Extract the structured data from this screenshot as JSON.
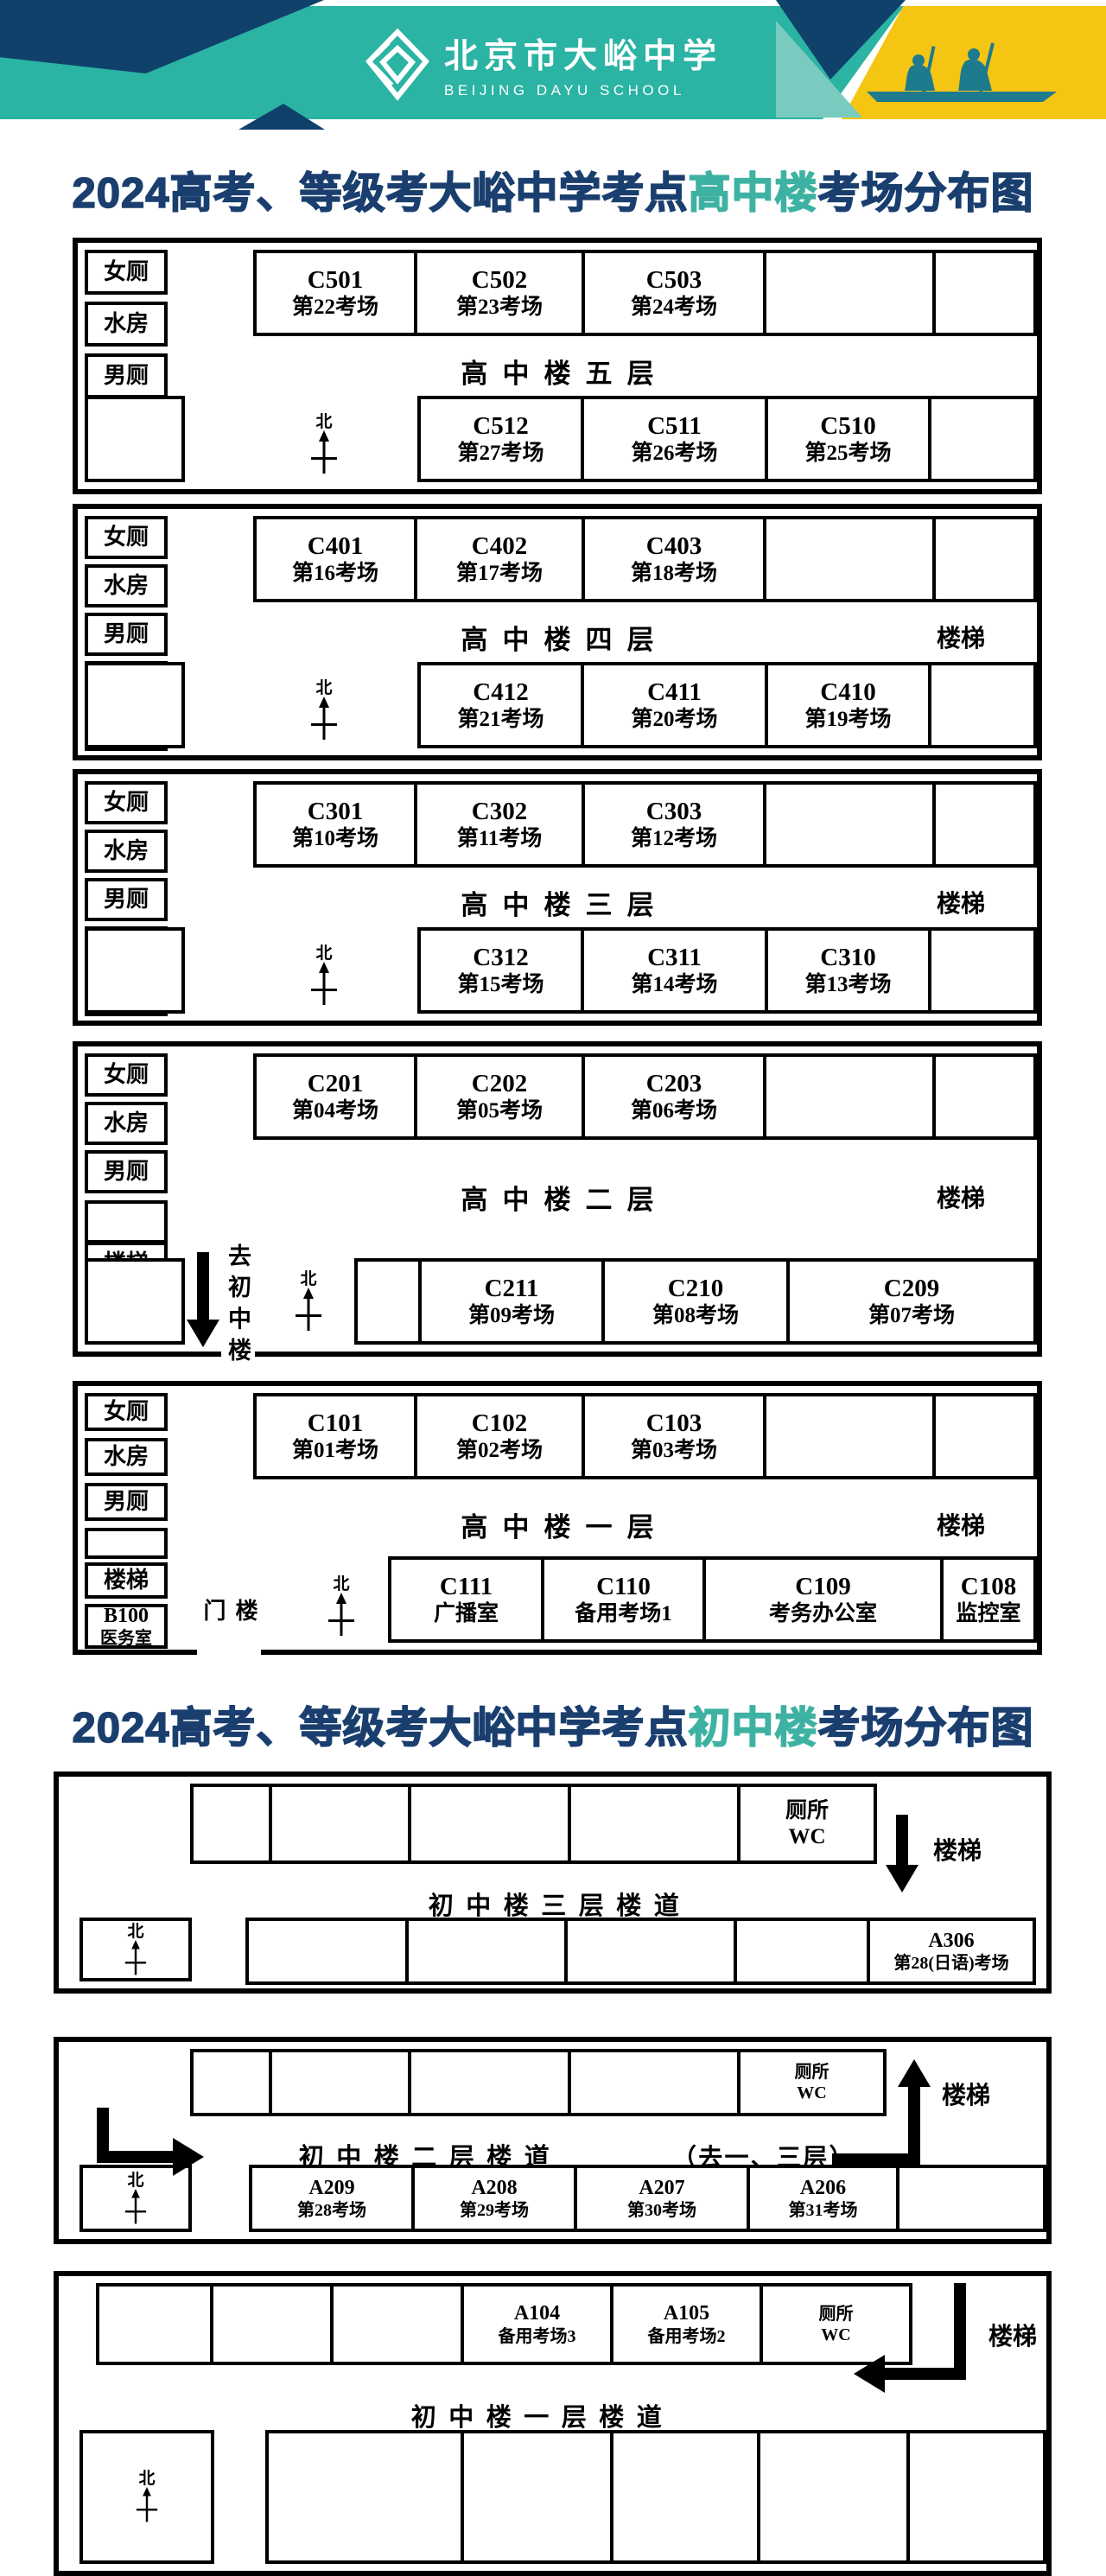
{
  "header": {
    "school_name_cn": "北京市大峪中学",
    "school_name_en": "BEIJING DAYU SCHOOL"
  },
  "colors": {
    "teal": "#2bb3a3",
    "navy": "#0f416b",
    "title-navy": "#1a3f6f",
    "title-teal": "#3eb2a2",
    "yellow": "#f5c513",
    "rower": "#1e7b8e",
    "light-teal": "#79cbc0"
  },
  "titles": {
    "hs": {
      "prefix": "2024高考、等级考大峪中学考点",
      "highlight": "高中楼",
      "suffix": "考场分布图"
    },
    "js": {
      "prefix": "2024高考、等级考大峪中学考点",
      "highlight": "初中楼",
      "suffix": "考场分布图"
    }
  },
  "common": {
    "north": "北",
    "stairs": "楼梯",
    "toilet_cn": "厕所",
    "toilet_en": "WC",
    "women": "女厕",
    "water": "水房",
    "men": "男厕"
  },
  "hs": {
    "f5": {
      "corridor": "高中楼五层",
      "top": [
        [
          "C501",
          "第22考场"
        ],
        [
          "C502",
          "第23考场"
        ],
        [
          "C503",
          "第24考场"
        ]
      ],
      "bottom": [
        [
          "C512",
          "第27考场"
        ],
        [
          "C511",
          "第26考场"
        ],
        [
          "C510",
          "第25考场"
        ]
      ]
    },
    "f4": {
      "corridor": "高中楼四层",
      "top": [
        [
          "C401",
          "第16考场"
        ],
        [
          "C402",
          "第17考场"
        ],
        [
          "C403",
          "第18考场"
        ]
      ],
      "bottom": [
        [
          "C412",
          "第21考场"
        ],
        [
          "C411",
          "第20考场"
        ],
        [
          "C410",
          "第19考场"
        ]
      ]
    },
    "f3": {
      "corridor": "高中楼三层",
      "top": [
        [
          "C301",
          "第10考场"
        ],
        [
          "C302",
          "第11考场"
        ],
        [
          "C303",
          "第12考场"
        ]
      ],
      "bottom": [
        [
          "C312",
          "第15考场"
        ],
        [
          "C311",
          "第14考场"
        ],
        [
          "C310",
          "第13考场"
        ]
      ]
    },
    "f2": {
      "corridor": "高中楼二层",
      "exit_note": "去初中楼",
      "top": [
        [
          "C201",
          "第04考场"
        ],
        [
          "C202",
          "第05考场"
        ],
        [
          "C203",
          "第06考场"
        ]
      ],
      "bottom": [
        [
          "C211",
          "第09考场"
        ],
        [
          "C210",
          "第08考场"
        ],
        [
          "C209",
          "第07考场"
        ]
      ]
    },
    "f1": {
      "corridor": "高中楼一层",
      "gate": "楼门",
      "medical": [
        "B100",
        "医务室"
      ],
      "top": [
        [
          "C101",
          "第01考场"
        ],
        [
          "C102",
          "第02考场"
        ],
        [
          "C103",
          "第03考场"
        ]
      ],
      "bottom": [
        [
          "C111",
          "广播室"
        ],
        [
          "C110",
          "备用考场1"
        ],
        [
          "C109",
          "考务办公室"
        ],
        [
          "C108",
          "监控室"
        ]
      ]
    }
  },
  "js": {
    "f3": {
      "corridor": "初中楼三层楼道",
      "room": [
        "A306",
        "第28(日语)考场"
      ]
    },
    "f2": {
      "corridor": "初中楼二层楼道",
      "note": "（去一、三层）",
      "rooms": [
        [
          "A209",
          "第28考场"
        ],
        [
          "A208",
          "第29考场"
        ],
        [
          "A207",
          "第30考场"
        ],
        [
          "A206",
          "第31考场"
        ]
      ]
    },
    "f1": {
      "corridor": "初中楼一层楼道",
      "rooms": [
        [
          "A104",
          "备用考场3"
        ],
        [
          "A105",
          "备用考场2"
        ]
      ]
    }
  }
}
